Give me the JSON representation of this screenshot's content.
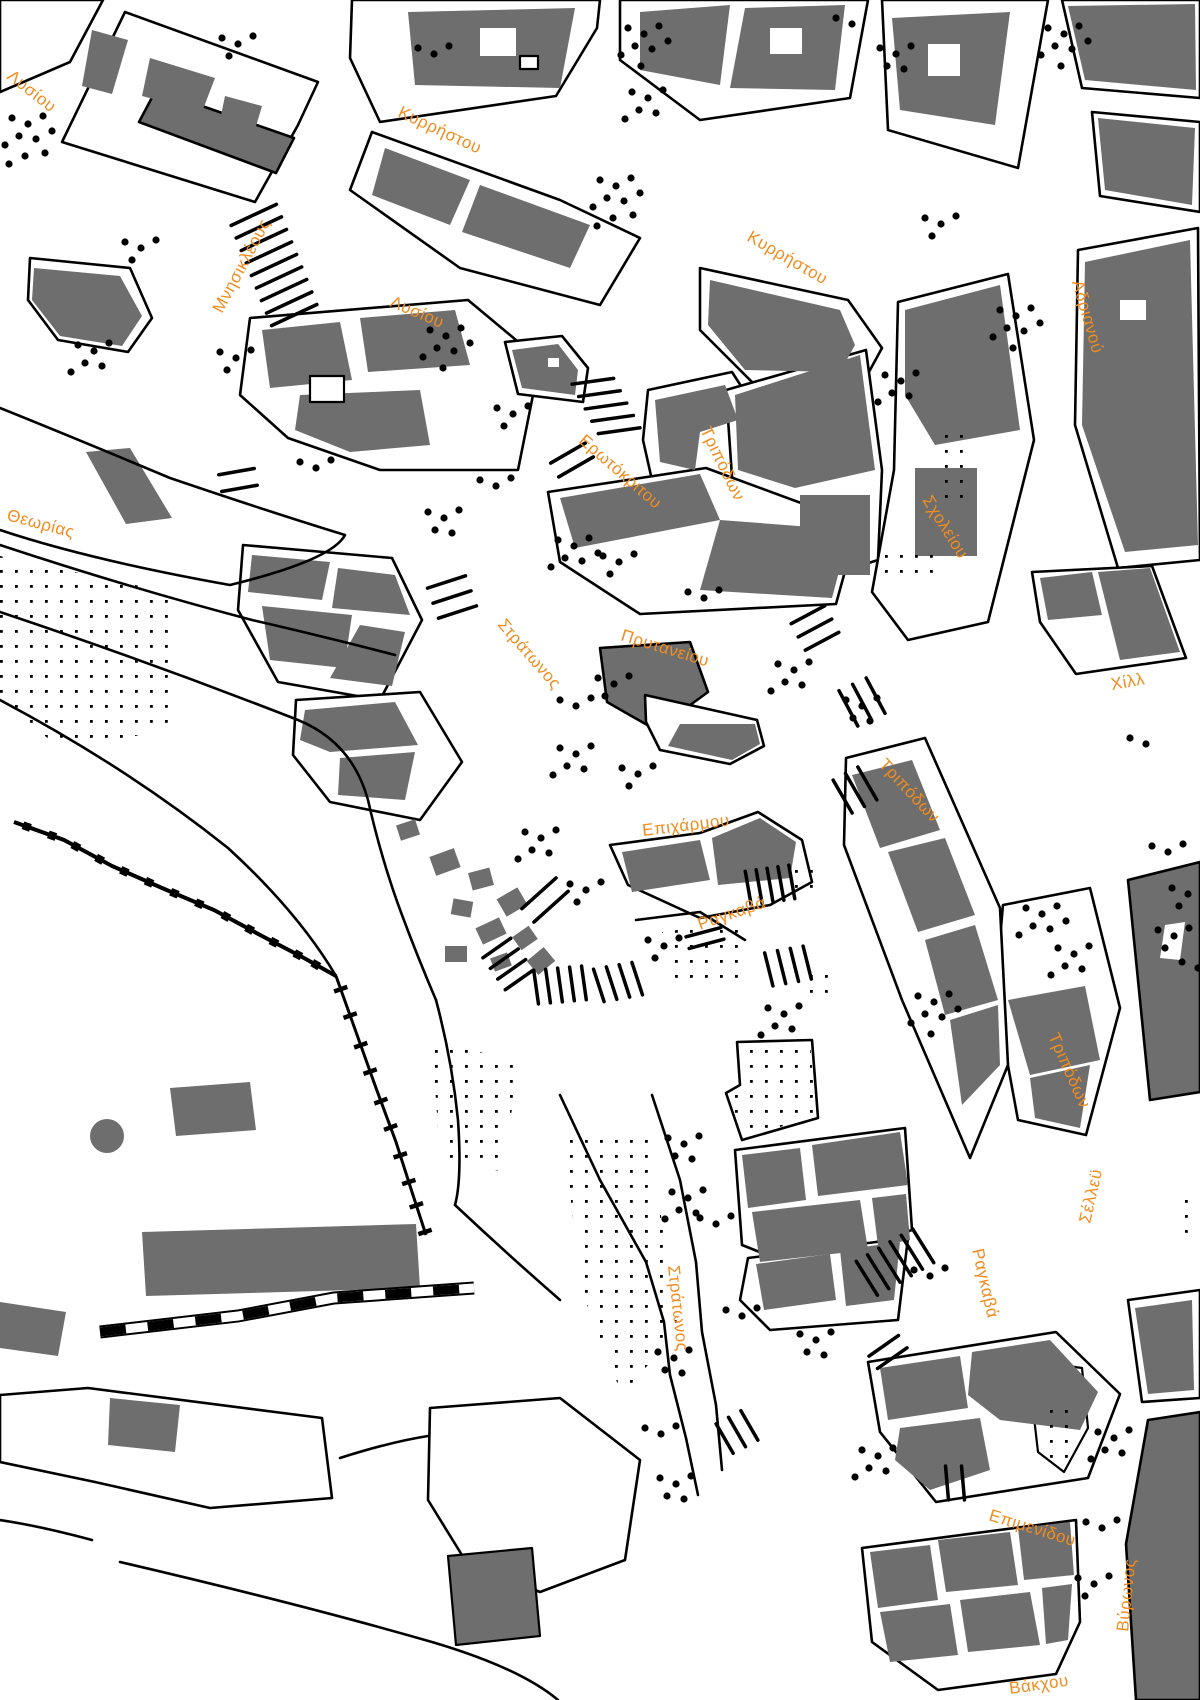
{
  "map": {
    "street_labels": [
      {
        "text": "Λυσίου"
      },
      {
        "text": "Κυρρήστου"
      },
      {
        "text": "Κυρρήστου"
      },
      {
        "text": "Αδριανού"
      },
      {
        "text": "Μνησικλέους"
      },
      {
        "text": "Λυσίου"
      },
      {
        "text": "Ερωτόκριτου"
      },
      {
        "text": "Τριπόδων"
      },
      {
        "text": "Σχολείου"
      },
      {
        "text": "Θεωρίας"
      },
      {
        "text": "Στράτωνος"
      },
      {
        "text": "Πρυτανείου"
      },
      {
        "text": "Χίλλ"
      },
      {
        "text": "Τριπόδων"
      },
      {
        "text": "Επιχάρμου"
      },
      {
        "text": "Ραγκαβά"
      },
      {
        "text": "Τριπόδων"
      },
      {
        "text": "Σέλλεϋ"
      },
      {
        "text": "Ραγκαβά"
      },
      {
        "text": "Στράτωνος"
      },
      {
        "text": "Επιμενίδου"
      },
      {
        "text": "Βύρωνος"
      },
      {
        "text": "Βάκχου"
      }
    ]
  },
  "colors": {
    "label": "#f28c1e",
    "building": "#6e6e6e",
    "line": "#000000",
    "background": "#ffffff"
  }
}
